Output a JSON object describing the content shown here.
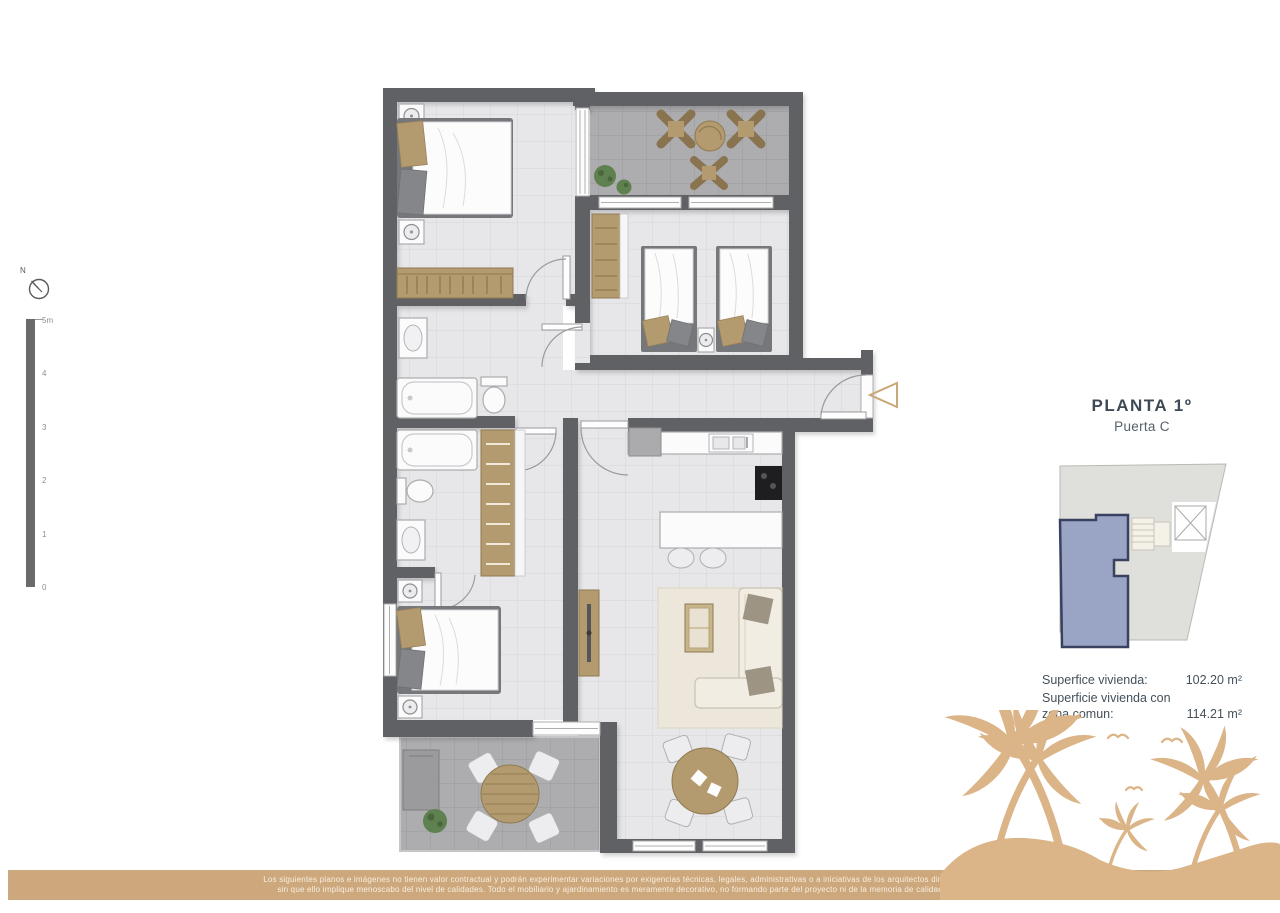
{
  "header": {
    "title": "PLANTA 1º",
    "subtitle": "Puerta C"
  },
  "compass": {
    "label": "N"
  },
  "scale_bar": {
    "labels": [
      "5m",
      "4",
      "3",
      "2",
      "1",
      "0"
    ]
  },
  "key_plan": {
    "building_fill": "#dfdfdc",
    "unit_fill": "#9aa5c6",
    "unit_outline": "#39415f"
  },
  "areas": {
    "rows": [
      {
        "label": "Superfice vivienda:",
        "value": "102.20 m²"
      },
      {
        "label": "Superficie vivienda con zona comun:",
        "value": "114.21 m²"
      }
    ]
  },
  "floor_plan": {
    "wall_color": "#5f6165",
    "interior_floor_color": "#e7e7e9",
    "terrace_floor_color": "#adadaf",
    "furniture_wood_color": "#b49b6f",
    "entrance_marker_color": "#c9a878"
  },
  "footer": {
    "bar_color": "#cda87d",
    "palm_color": "#dbb488",
    "disclaimer_line1": "Los siguientes planos e imágenes no tienen valor contractual y podrán experimentar variaciones por exigencias técnicas, legales, administrativas o a iniciativas de los arquitectos directores de las obras",
    "disclaimer_line2": "sin que ello implique menoscabo del nivel de calidades. Todo el mobiliario y ajardinamiento es meramente decorativo, no formando parte del proyecto ni de la memoria de calidades del proyecto."
  }
}
